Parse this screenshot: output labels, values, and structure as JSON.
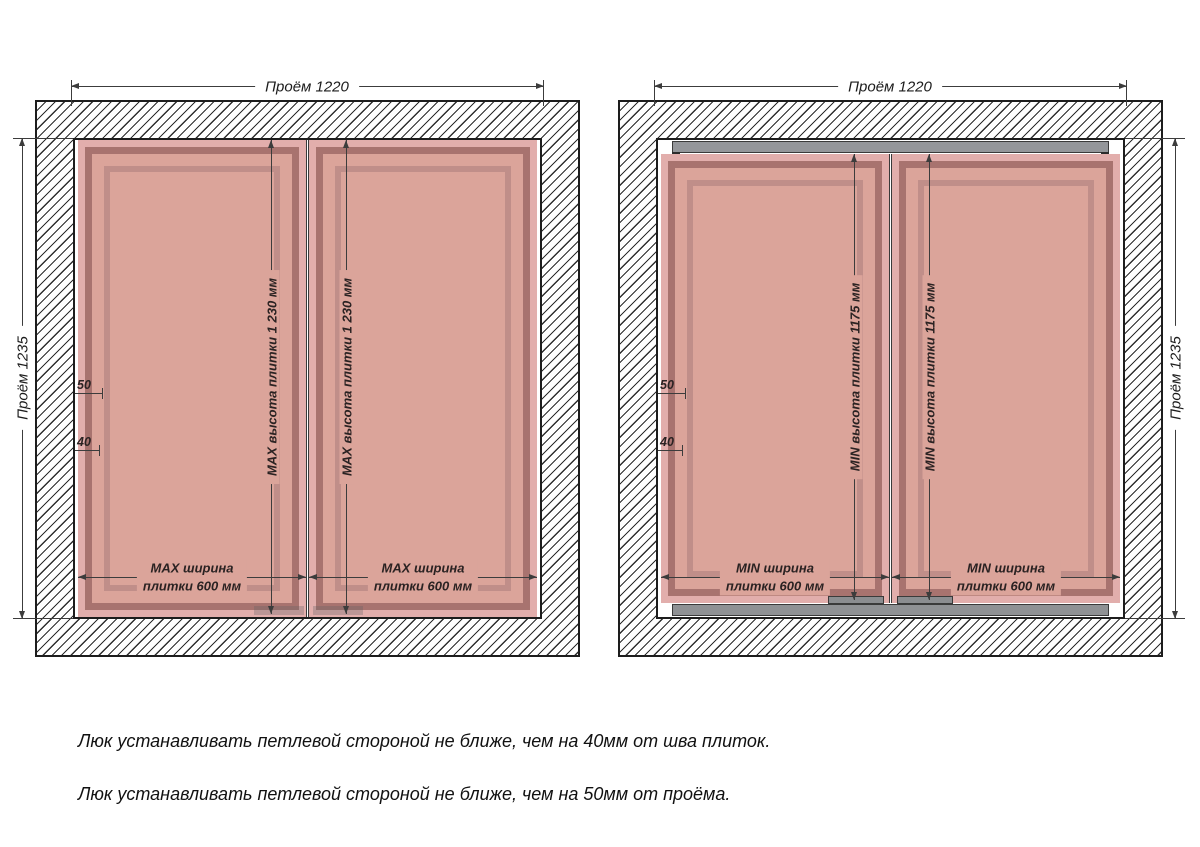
{
  "colors": {
    "tile_field": "#dba49a",
    "tile_edge_light": "#e2aeac",
    "tile_frame_dark": "#a8736f",
    "hatch_frame_gray": "#94969a",
    "dim_line": "#3c3c3c"
  },
  "diagrams": [
    {
      "name": "max-tile-size",
      "opening_width_label": "Проём 1220",
      "opening_height_label": "Проём 1235",
      "tile_height_label": "MAX высота плитки 1 230 мм",
      "tile_width_label_1": "MAX ширина",
      "tile_width_label_2": "плитки 600 мм",
      "offset_from_opening": "50",
      "offset_from_seam": "40"
    },
    {
      "name": "min-tile-size",
      "opening_width_label": "Проём 1220",
      "opening_height_label": "Проём 1235",
      "tile_height_label": "MIN высота плитки 1175 мм",
      "tile_width_label_1": "MIN ширина",
      "tile_width_label_2": "плитки 600 мм",
      "offset_from_opening": "50",
      "offset_from_seam": "40"
    }
  ],
  "notes": [
    "Люк устанавливать петлевой стороной не ближе, чем на 40мм от шва плиток.",
    "Люк устанавливать петлевой стороной не ближе, чем на 50мм от проёма."
  ]
}
